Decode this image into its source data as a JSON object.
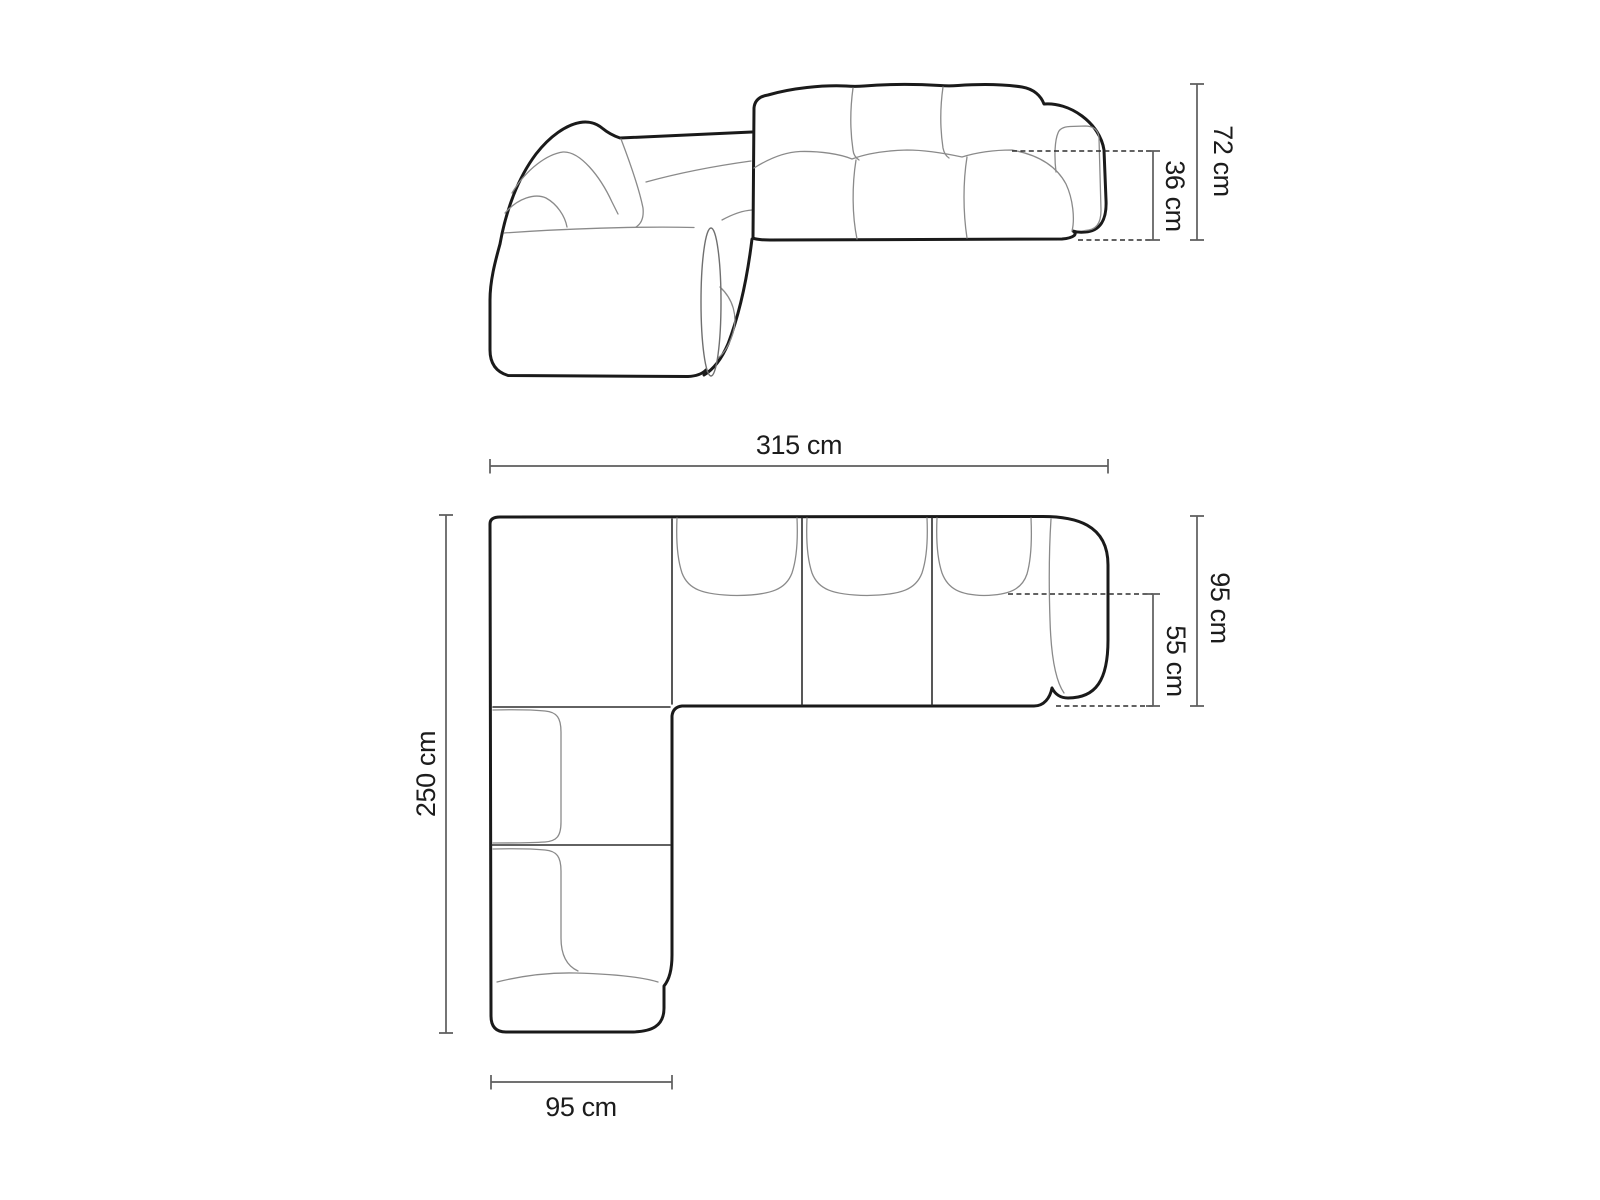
{
  "diagram": {
    "title": "corner-sofa-dimension-drawing",
    "background": "#ffffff",
    "views": {
      "elevation": {
        "name": "side elevation view",
        "dimensions": {
          "total_height": "72 cm",
          "seat_height": "36 cm"
        }
      },
      "plan": {
        "name": "top plan view",
        "dimensions": {
          "total_width": "315 cm",
          "total_depth": "250 cm",
          "side_depth": "95 cm",
          "seat_depth": "55 cm",
          "chaise_width": "95 cm"
        }
      }
    },
    "colors": {
      "outline": "#1a1a1a",
      "detail_line": "#8a8a8a",
      "dimension_line": "#5d5d5d",
      "dashed_line": "#2e2e2e",
      "label_text": "#1c1c1c"
    }
  }
}
